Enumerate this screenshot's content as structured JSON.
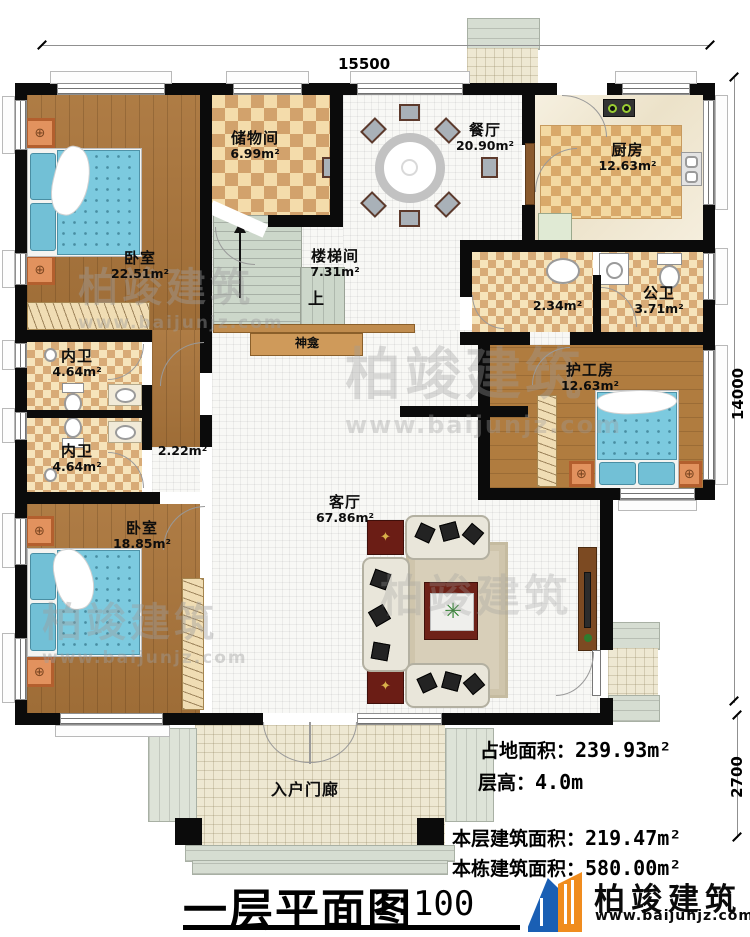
{
  "plan": {
    "dimensions": {
      "width": "15500",
      "height": "14000",
      "porch_depth": "2700"
    },
    "rooms": [
      {
        "name": "卧室",
        "area": "22.51m²"
      },
      {
        "name": "储物间",
        "area": "6.99m²"
      },
      {
        "name": "楼梯间",
        "area": "7.31m²"
      },
      {
        "name": "餐厅",
        "area": "20.90m²"
      },
      {
        "name": "厨房",
        "area": "12.63m²"
      },
      {
        "name": "",
        "area": "2.34m²"
      },
      {
        "name": "公卫",
        "area": "3.71m²"
      },
      {
        "name": "护工房",
        "area": "12.63m²"
      },
      {
        "name": "内卫",
        "area": "4.64m²"
      },
      {
        "name": "内卫",
        "area": "4.64m²"
      },
      {
        "name": "卧室",
        "area": "18.85m²"
      },
      {
        "name": "客厅",
        "area": "67.86m²"
      },
      {
        "name": "",
        "area": "2.22m²"
      },
      {
        "name": "入户门廊",
        "area": ""
      }
    ],
    "labels": {
      "shrine": "神龛",
      "stairs_up": "上"
    },
    "info": [
      {
        "label": "占地面积：",
        "value": "239.93m²"
      },
      {
        "label": "层高：",
        "value": "4.0m"
      },
      {
        "label": "本层建筑面积：",
        "value": "219.47m²"
      },
      {
        "label": "本栋建筑面积：",
        "value": "580.00m²"
      }
    ],
    "title_block": {
      "title": "一层平面图",
      "scale": "1:100"
    },
    "brand": {
      "name": "柏竣建筑",
      "site": "www.baijunjz.com"
    },
    "watermark": {
      "text": "柏竣建筑",
      "site": "www.baijunjz.com"
    },
    "colors": {
      "wall": "#0b0b0b",
      "wood": "#aa753b",
      "checker_dark": "#d2a26c",
      "checker_light": "#f4dcab",
      "bed_blue": "#7ccadf",
      "brand_blue": "#1a5fb4",
      "brand_orange": "#f08c1e"
    }
  }
}
